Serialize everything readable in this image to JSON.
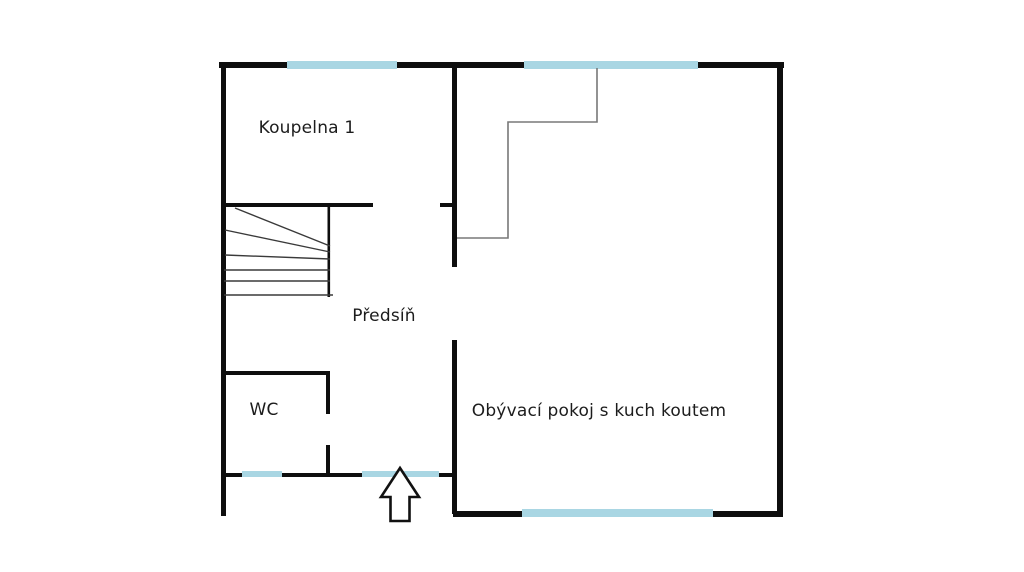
{
  "floorplan": {
    "rooms": {
      "bathroom": {
        "label": "Koupelna 1"
      },
      "hallway": {
        "label": "Předsíň"
      },
      "wc": {
        "label": "WC"
      },
      "living_room": {
        "label": "Obývací pokoj s kuch koutem"
      }
    },
    "entrance": {
      "icon": "up-arrow-entrance"
    }
  },
  "colors": {
    "wall": "#0e0e0e",
    "window": "#a9d6e3",
    "stair_line": "#3a3a3a",
    "detail_line": "#787878",
    "label_text": "#1c1c1c",
    "arrow_fill": "#ffffff",
    "arrow_stroke": "#111111"
  }
}
